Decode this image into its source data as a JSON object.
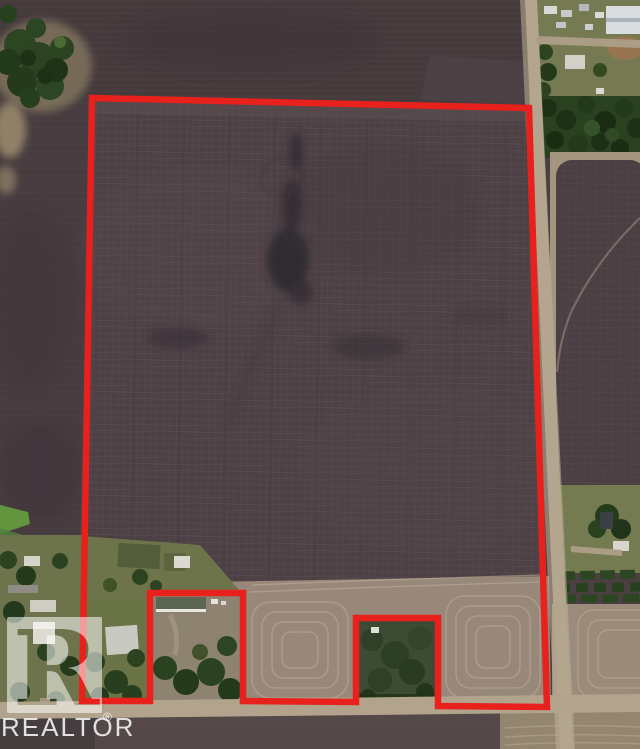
{
  "image_type": "aerial-satellite-photo-of-farmland-parcel",
  "watermark": {
    "logo_icon": "realtor-block-r-logo",
    "brand_text": "REALTOR",
    "registered_symbol": "®"
  },
  "parcel_boundary": {
    "stroke_color": "#e8211d",
    "stroke_width": "6.5",
    "points": "92,98 529,108 547,707 438,706 438,618 356,618 356,702 243,701 243,593 150,593 150,701 82,701"
  },
  "palette": {
    "boundary_red": "#e8211d",
    "plowed_field_dark": "#4e4145",
    "field_grid_line": "#7b6a6c",
    "top_field": "#453a3c",
    "hay_stubble_tan": "#97887a",
    "contour_line_tan": "#bfae97",
    "road_tan": "#b4a68e",
    "farmyard_olive": "#6f7549",
    "bright_green_strip": "#63953f",
    "tree_green": "#2b4320",
    "forest_dark_green": "#1d3016",
    "building_white": "#dcdad3",
    "watermark_white": "rgba(255,255,255,0.55)"
  }
}
